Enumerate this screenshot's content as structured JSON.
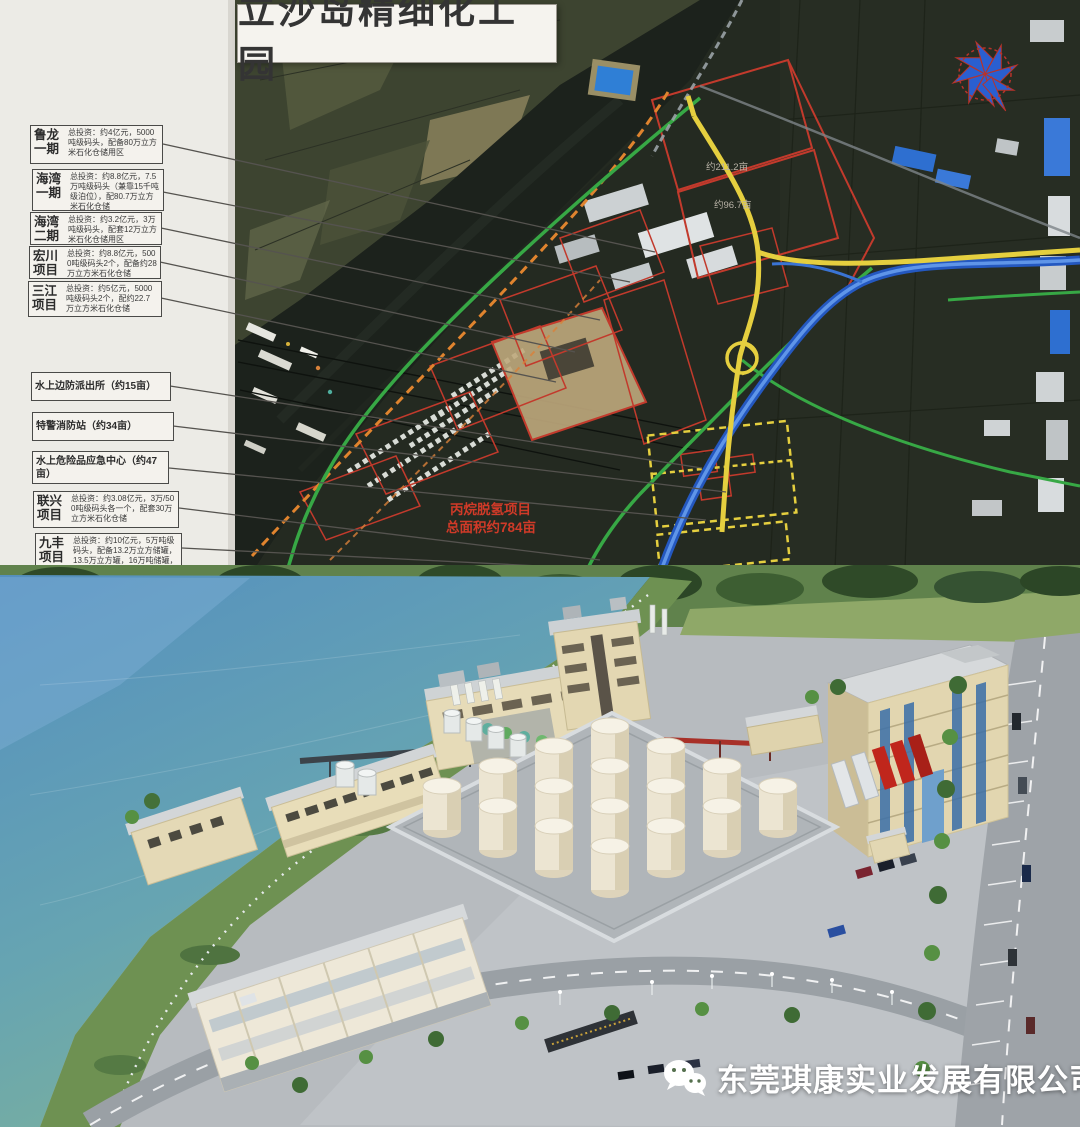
{
  "page": {
    "width": 1080,
    "height": 1127
  },
  "map": {
    "title": "立沙岛精细化工园",
    "callouts": [
      {
        "name": "鲁龙一期",
        "desc": "总投资：约4亿元，5000吨级码头，配备80万立方米石化仓储用区"
      },
      {
        "name": "海湾一期",
        "desc": "总投资：约8.8亿元，7.5万吨级码头（兼靠15千吨级泊位），配80.7万立方米石化仓储"
      },
      {
        "name": "海湾二期",
        "desc": "总投资：约3.2亿元，3万吨级码头，配套12万立方米石化仓储用区"
      },
      {
        "name": "宏川项目",
        "desc": "总投资：约8.8亿元，5000吨级码头2个，配备约28万立方米石化仓储"
      },
      {
        "name": "三江项目",
        "desc": "总投资：约5亿元，5000吨级码头2个，配约22.7万立方米石化仓储"
      },
      {
        "name": "水上边防派出所（约15亩）",
        "desc": ""
      },
      {
        "name": "特警消防站（约34亩）",
        "desc": ""
      },
      {
        "name": "水上危险品应急中心（约47亩）",
        "desc": ""
      },
      {
        "name": "联兴项目",
        "desc": "总投资：约3.08亿元，3万/500吨级码头各一个，配套30万立方米石化仓储"
      },
      {
        "name": "九丰项目",
        "desc": "总投资：约10亿元，5万吨级码头，配备13.2万立方储罐，13.5万立方罐，16万吨储罐，20…"
      }
    ],
    "annotations": {
      "project_label_line1": "丙烷脱氢项目",
      "project_label_line2": "总面积约784亩",
      "parcel_area_1": "约211.2亩",
      "parcel_area_2": "约96.7亩"
    },
    "compass_icon": "compass-pinwheel"
  },
  "render": {
    "watermark_text": "东莞琪康实业发展有限公司",
    "watermark_icon": "wechat"
  },
  "colors": {
    "road_yellow": "#e5cf3f",
    "road_green": "#37a845",
    "road_blue": "#2458c0",
    "parcel_red": "#c23a2c",
    "shoreline_orange": "#e0842e",
    "annotation_red": "#d03a28",
    "watermark_white": "#ffffff"
  }
}
